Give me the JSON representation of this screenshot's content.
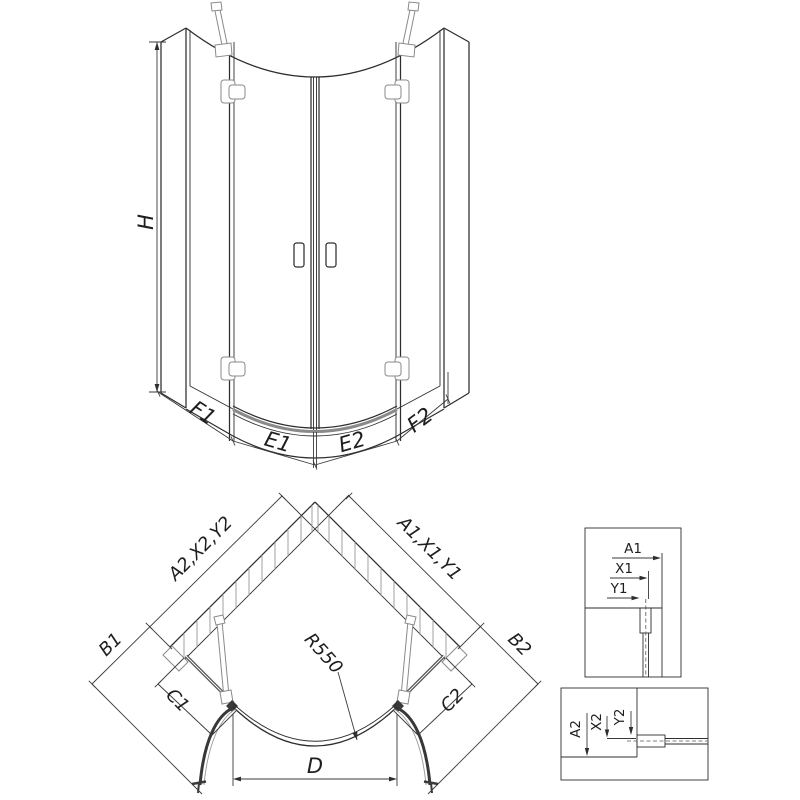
{
  "front": {
    "h": "H",
    "f1": "F1",
    "e1": "E1",
    "e2": "E2",
    "f2": "F2"
  },
  "plan": {
    "wall_left": "A2,X2,Y2",
    "wall_right": "A1,X1,Y1",
    "b1": "B1",
    "b2": "B2",
    "c1": "C1",
    "c2": "C2",
    "radius": "R550",
    "d": "D"
  },
  "detail_top": {
    "a1": "A1",
    "x1": "X1",
    "y1": "Y1"
  },
  "detail_bottom": {
    "a2": "A2",
    "x2": "X2",
    "y2": "Y2"
  },
  "colors": {
    "line": "#2e2e2e",
    "light": "#979797"
  }
}
